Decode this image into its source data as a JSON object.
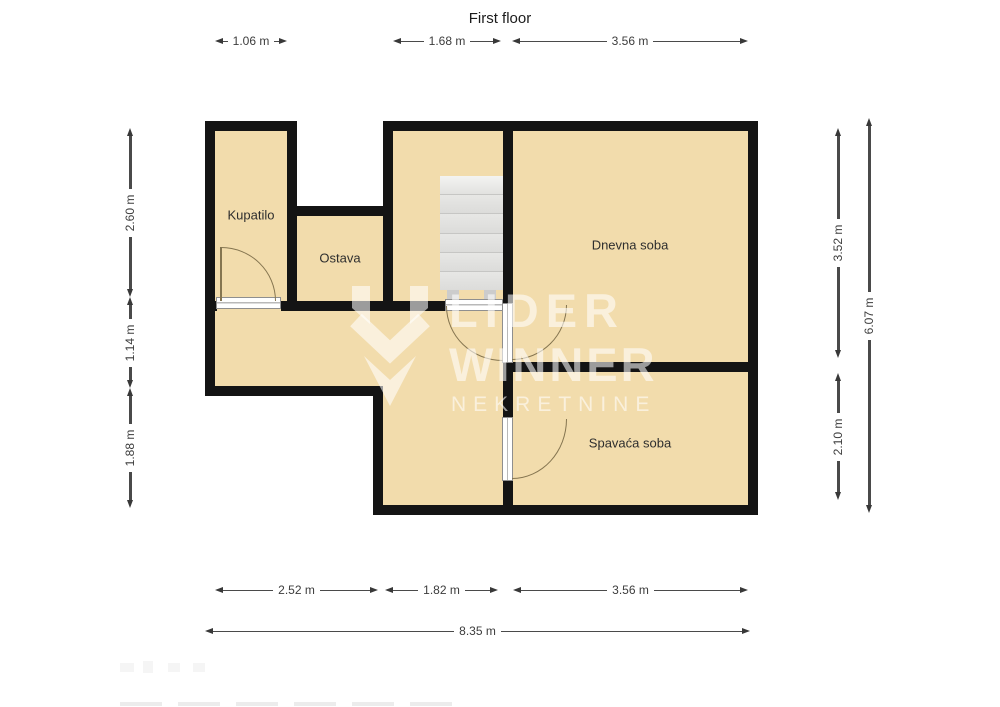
{
  "title": "First floor",
  "rooms": {
    "kupatilo": {
      "label": "Kupatilo"
    },
    "ostava": {
      "label": "Ostava"
    },
    "dnevna": {
      "label": "Dnevna soba"
    },
    "spavaca": {
      "label": "Spavaća soba"
    }
  },
  "dimensions": {
    "top_kupatilo": "1.06 m",
    "top_hall": "1.68 m",
    "top_dnevna": "3.56 m",
    "left_upper": "2.60 m",
    "left_middle": "1.14 m",
    "left_lower": "1.88 m",
    "right_dnevna": "3.52 m",
    "right_spavaca": "2.10 m",
    "right_total": "6.07 m",
    "bottom_left": "2.52 m",
    "bottom_hall": "1.82 m",
    "bottom_spavaca": "3.56 m",
    "bottom_total": "8.35 m"
  },
  "watermark": {
    "line1": "LIDER",
    "line2": "WINNER",
    "line3": "NEKRETNINE"
  },
  "colors": {
    "room_fill": "#f2dcac",
    "wall": "#141414",
    "stairs": "#dededc",
    "door_arc": "#857550",
    "dimension": "#3c3c3c",
    "watermark": "rgba(255,255,255,0.58)"
  }
}
